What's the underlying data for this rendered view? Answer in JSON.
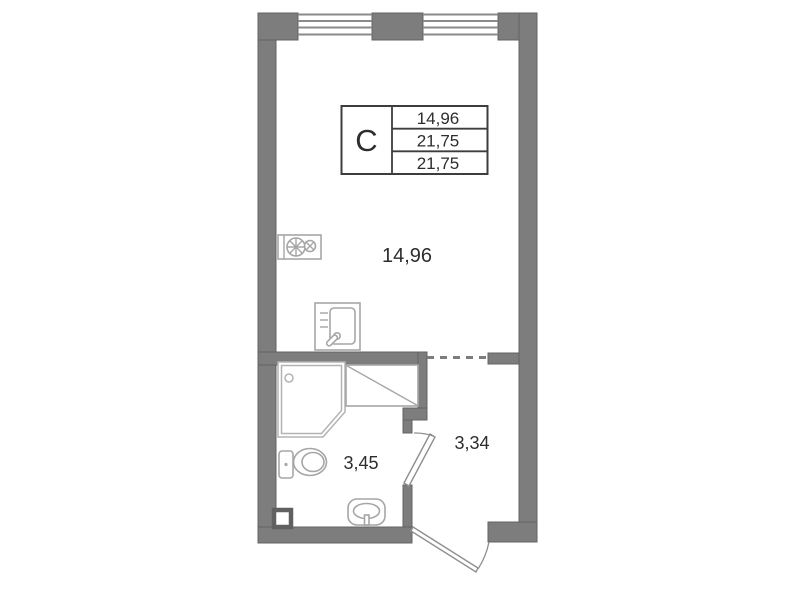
{
  "legend": {
    "type_label": "С",
    "rows": [
      {
        "value": "14,96"
      },
      {
        "value": "21,75"
      },
      {
        "value": "21,75"
      }
    ]
  },
  "rooms": {
    "living": {
      "area": "14,96"
    },
    "bathroom": {
      "area": "3,45"
    },
    "hallway": {
      "area": "3,34"
    }
  },
  "icons": [
    "stove-icon",
    "kitchen-sink-icon",
    "shower-icon",
    "toilet-icon",
    "washbasin-icon",
    "vent-duct-icon",
    "window-icon",
    "door-swing-icon"
  ],
  "colors": {
    "wall": "#7d7d7d",
    "wall_edge": "#636363",
    "window_line": "#8a8a8a",
    "fixture": "#a6a6a6",
    "fixture_light": "#b3b3b3",
    "door": "#8f8f8f",
    "text": "#2d2d2d",
    "legend_border": "#3d3d3d",
    "background": "#ffffff"
  }
}
